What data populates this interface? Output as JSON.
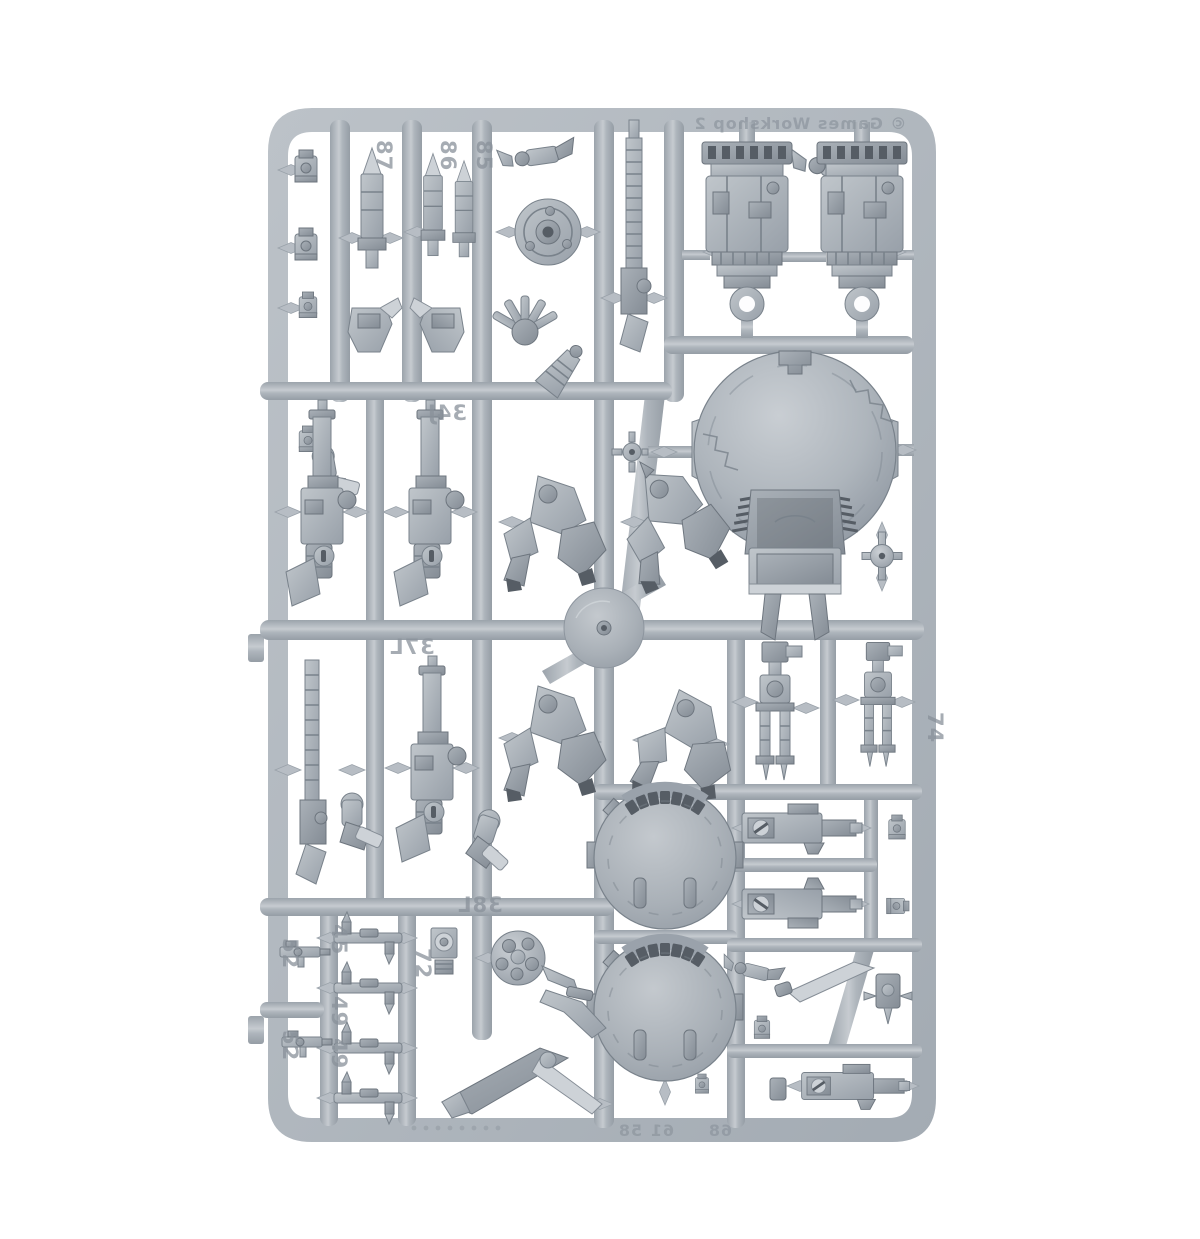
{
  "scene": {
    "type": "product photo",
    "subject": "Grey plastic miniature wargame model sprue (injection-moulded runner with parts) photographed on a white background",
    "background_color": "#ffffff"
  },
  "sprue": {
    "plastic_color": "#b3bac1",
    "part_shadow_color": "#868e97",
    "part_highlight_color": "#d8dce0",
    "slot_color": "#565d65",
    "copyright": "© Games Workshop 2",
    "numbers": {
      "n87": "87",
      "n86": "86",
      "n85": "85",
      "n34j": "34J",
      "n37l": "37L",
      "n38l": "38L",
      "n52a": "52",
      "n52b": "52",
      "n45": "45",
      "n49a": "49",
      "n49b": "49",
      "n72": "72",
      "n58": "58",
      "n61": "61",
      "n68": "68",
      "n74": "74"
    },
    "contents": [
      "2 turret housings",
      "1 large drone dome with intake scoop",
      "2 drone body top shells",
      "3 pulse rifles",
      "1 long rail-rifle barrel",
      "4 crouching leg assemblies",
      "2 sensor masts",
      "2 drone carbines",
      "1 round hatch dial",
      "1 spiked generator sphere",
      "1 socketed drone sphere",
      "5 antenna linkages",
      "1 stabilizer fin",
      "1 blade",
      "assorted small fittings, missiles and arms"
    ]
  }
}
